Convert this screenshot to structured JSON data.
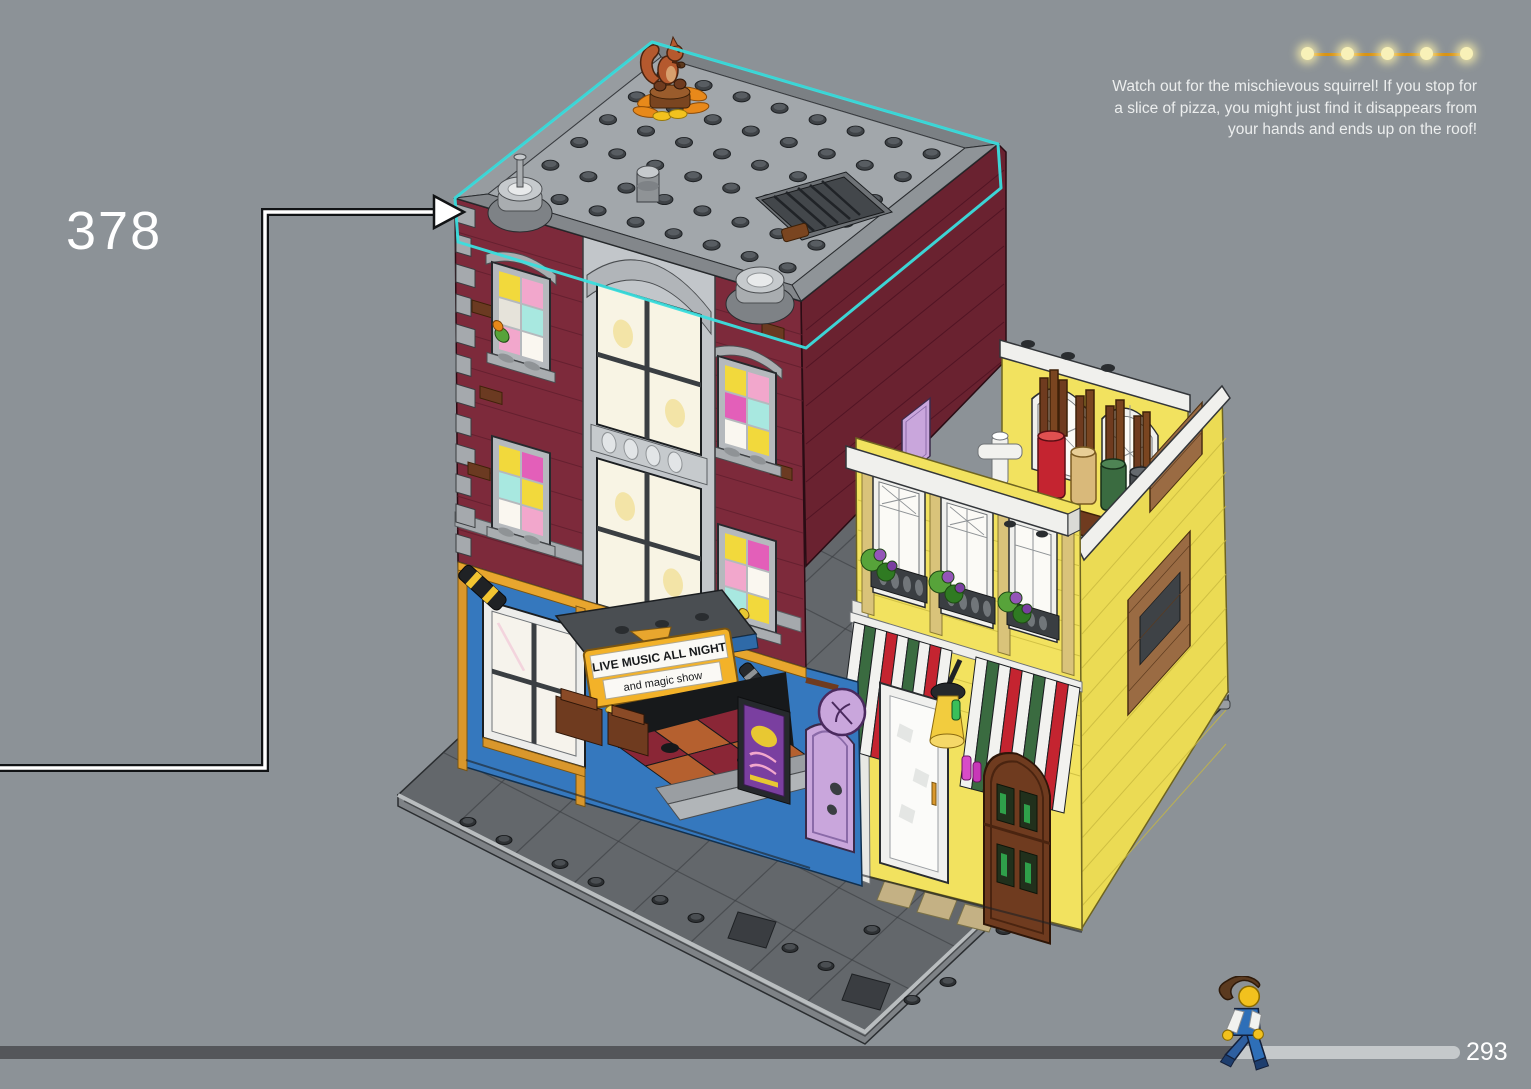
{
  "page": {
    "step_number": "378",
    "page_number": "293"
  },
  "annotation": {
    "lines": [
      "Watch out for the mischievous squirrel! If you stop for",
      "a slice of pizza, you might just find it disappears from",
      "your hands and ends up on the roof!"
    ]
  },
  "marquee": {
    "line1": "LIVE MUSIC ALL NIGHT",
    "line2": "and magic show"
  },
  "lights": {
    "count": 5
  },
  "progress": {
    "fraction": 0.845
  },
  "colors": {
    "background": "#8C9297",
    "highlight_outline": "#3BDEDE",
    "brick_maroon": "#7D2A3B",
    "brick_maroon_dark": "#6A2230",
    "storefront_blue": "#3578BE",
    "pizzeria_yellow": "#F2E25F",
    "awning_red": "#C42430",
    "awning_green": "#3A6B40",
    "marquee_gold": "#F3B229",
    "lavender": "#C9A6DC",
    "door_brown": "#6F3B1F",
    "roof_gray": "#A2A7AB",
    "progress_filled": "#54565A",
    "progress_remaining": "#C5C9CB",
    "string_light": "#F7EFB2",
    "string_wire": "#D89315",
    "text": "#FFFFFF"
  }
}
